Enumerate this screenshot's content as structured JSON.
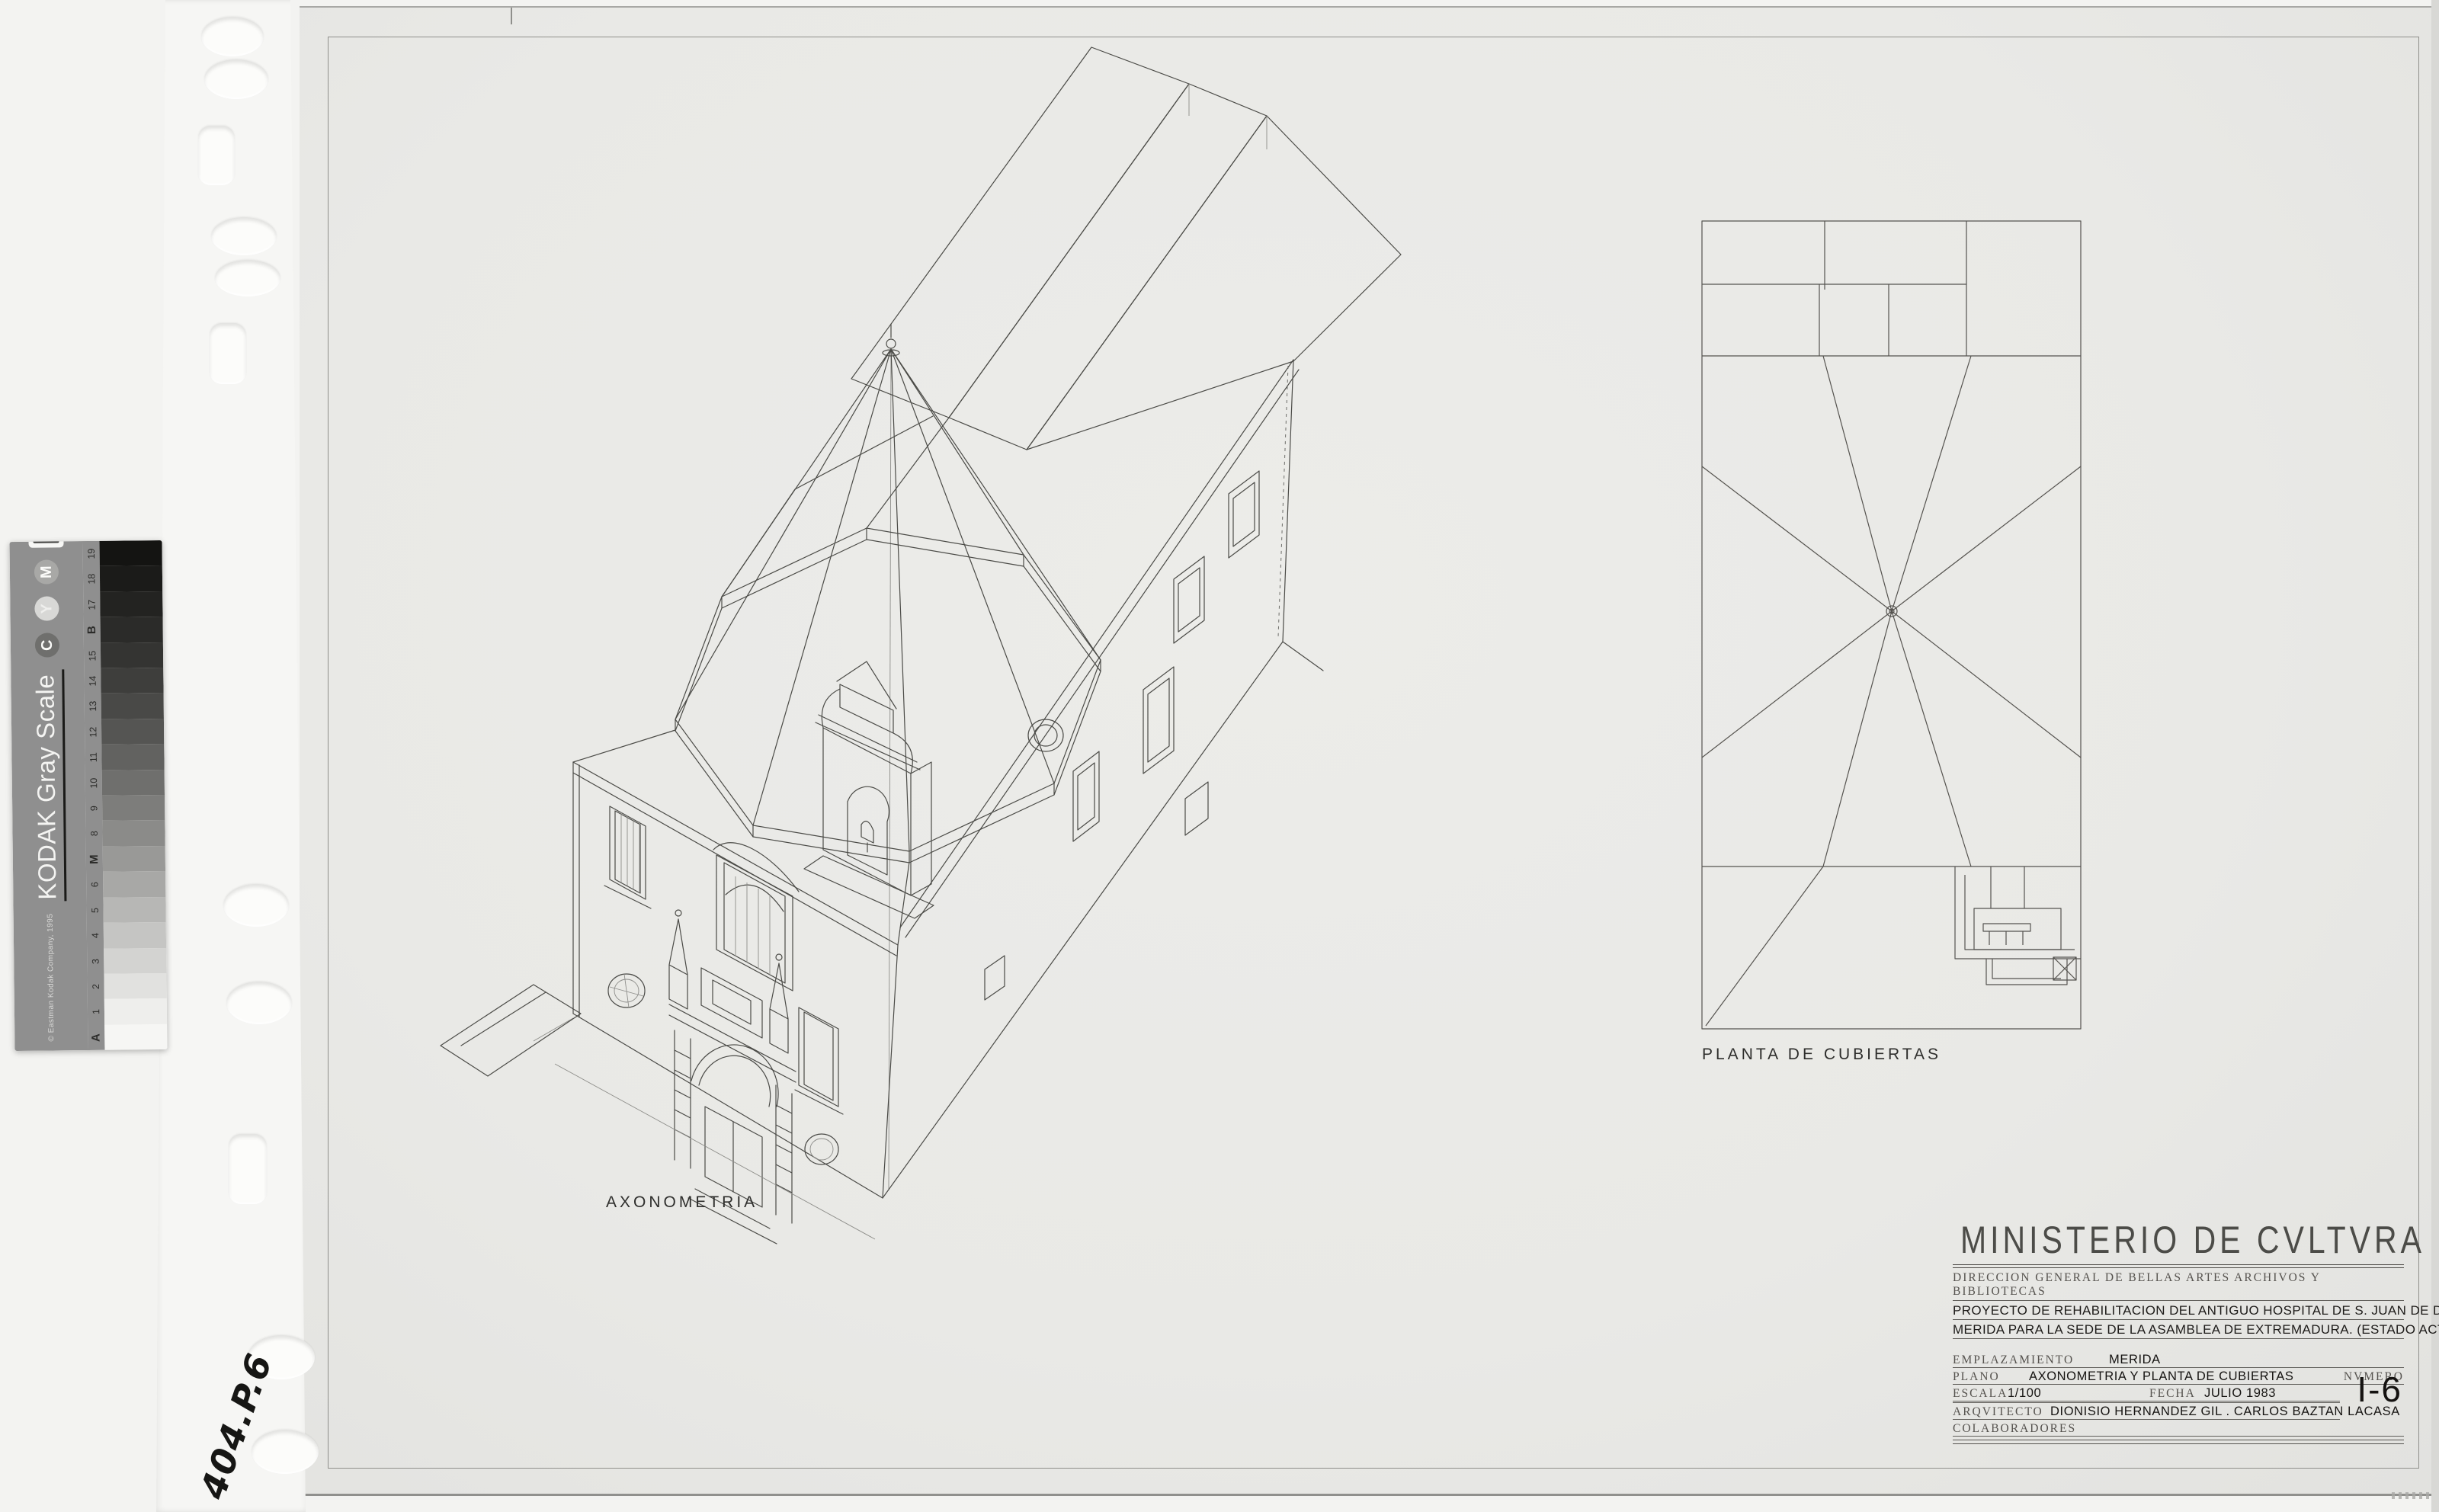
{
  "film": {
    "handwritten_ref": "404.P.6"
  },
  "kodak_strip": {
    "title": "KODAK Gray Scale",
    "copyright": "© Eastman Kodak Company, 1995",
    "logo_brand": "Kodak",
    "registration_circles": [
      "C",
      "Y",
      "M"
    ],
    "labels_top_to_bottom": [
      "19",
      "18",
      "17",
      "B",
      "15",
      "14",
      "13",
      "12",
      "11",
      "10",
      "9",
      "8",
      "M",
      "6",
      "5",
      "4",
      "3",
      "2",
      "1",
      "A"
    ],
    "patch_colors_top_to_bottom": [
      "#141412",
      "#1b1b19",
      "#232321",
      "#2b2b29",
      "#343432",
      "#3e3e3c",
      "#494947",
      "#555553",
      "#626260",
      "#6f6f6d",
      "#7d7d7b",
      "#8b8b89",
      "#999997",
      "#a8a8a6",
      "#b7b7b5",
      "#c5c5c3",
      "#d3d3d1",
      "#e1e1df",
      "#eeeeec",
      "#f6f6f4"
    ],
    "label_band_color": "#8f8f8f"
  },
  "drawing": {
    "axon_label": "AXONOMETRIA",
    "roof_plan_label": "PLANTA DE CUBIERTAS"
  },
  "title_block": {
    "ministry": "MINISTERIO DE CVLTVRA",
    "department": "DIRECCION GENERAL DE BELLAS ARTES ARCHIVOS Y BIBLIOTECAS",
    "project_line1": "PROYECTO DE REHABILITACION DEL ANTIGUO HOSPITAL DE S. JUAN DE DIOS EN",
    "project_line2": "MERIDA PARA LA SEDE DE LA ASAMBLEA DE EXTREMADURA. (ESTADO ACTUAL)",
    "fields": {
      "emplazamiento_label": "EMPLAZAMIENTO",
      "emplazamiento": "MERIDA",
      "plano_label": "PLANO",
      "plano": "AXONOMETRIA Y PLANTA DE CUBIERTAS",
      "numero_label": "NVMERO",
      "escala_label": "ESCALA",
      "escala": "1/100",
      "fecha_label": "FECHA",
      "fecha": "JULIO 1983",
      "arquitecto_label": "ARQVITECTO",
      "arquitecto": "DIONISIO HERNANDEZ GIL . CARLOS BAZTAN LACASA",
      "colaboradores_label": "COLABORADORES",
      "numero": "I-6"
    }
  }
}
